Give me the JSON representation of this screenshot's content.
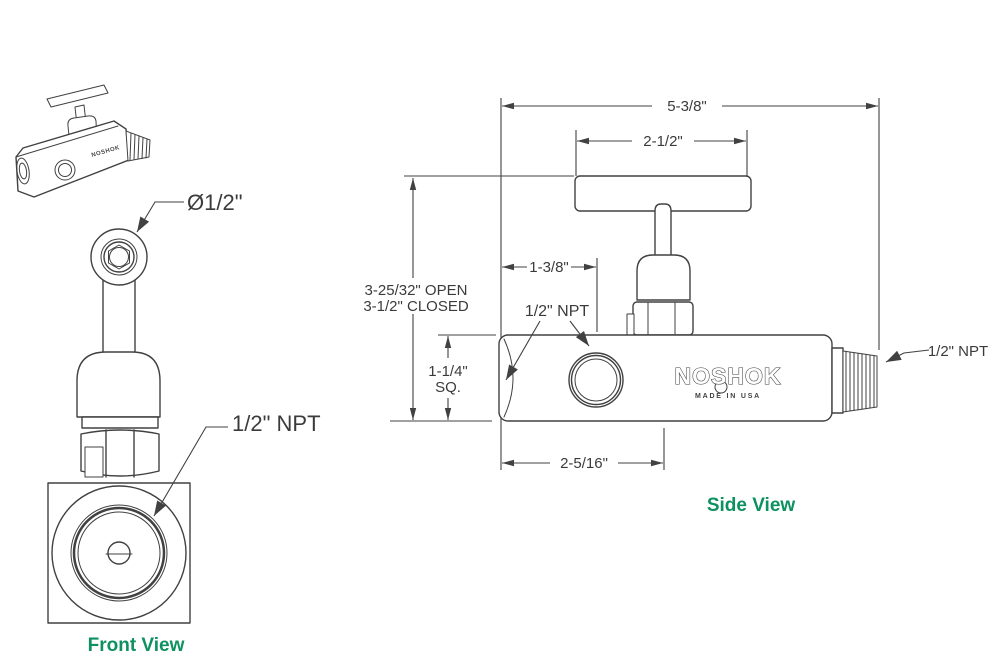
{
  "colors": {
    "line": "#414141",
    "text": "#3b3b3b",
    "accent_green": "#0e9160",
    "background": "#ffffff"
  },
  "thumbnail": {
    "brand": "NOSHOK"
  },
  "front_view": {
    "title": "Front View",
    "handle_diameter_label": "Ø1/2\"",
    "port_label": "1/2\" NPT"
  },
  "side_view": {
    "title": "Side View",
    "port_label_left": "1/2\" NPT",
    "port_label_right": "1/2\" NPT",
    "brand": "NOSHOK",
    "made_in": "MADE IN USA",
    "dimensions": {
      "overall_length": "5-3/8\"",
      "handle_width": "2-1/2\"",
      "inlet_to_gauge_port": "1-3/8\"",
      "height_open": "3-25/32\" OPEN",
      "height_closed": "3-1/2\" CLOSED",
      "body_square": "1-1/4\"",
      "body_square_suffix": "SQ.",
      "body_length": "2-5/16\""
    }
  }
}
